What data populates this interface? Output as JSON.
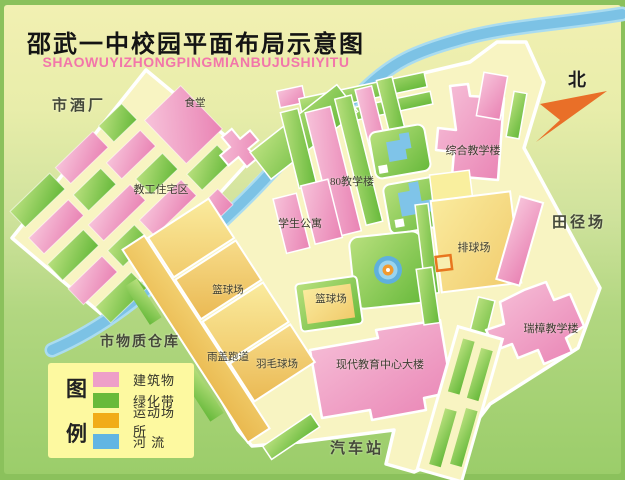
{
  "title": {
    "text": "邵武一中校园平面布局示意图",
    "pinyin": "SHAOWUYIZHONGPINGMIANBUJUSHIYITU"
  },
  "compass": {
    "north_label": "北"
  },
  "places": {
    "city_winery": "市酒厂",
    "canteen": "食堂",
    "staff_residential": "教工住宅区",
    "student_apartments": "学生公寓",
    "teaching_building_80": "80教学楼",
    "comprehensive_building": "综合教学楼",
    "track_field": "田径场",
    "volleyball_court": "排球场",
    "basketball_court_west": "篮球场",
    "basketball_court_center": "篮球场",
    "city_warehouse": "市物质仓库",
    "covered_track": "雨盖跑道",
    "badminton_court": "羽毛球场",
    "modern_education_center": "现代教育中心大楼",
    "ruizhang_building": "瑞樟教学楼",
    "bus_station": "汽车站"
  },
  "legend": {
    "title_char_top": "图",
    "title_char_bottom": "例",
    "items": [
      {
        "label": "建筑物",
        "color": "#ee9fc8"
      },
      {
        "label": "绿化带",
        "color": "#68ba3a"
      },
      {
        "label": "运动场所",
        "color": "#f1ac18"
      },
      {
        "label": "河 流",
        "color": "#62b5e3"
      }
    ]
  },
  "colors": {
    "building_pink": "#ee9fc8",
    "greenbelt": "#68ba3a",
    "sports": "#f1ac18",
    "river": "#62b5e3",
    "campus_ground": "#f8f4c2",
    "frame_green": "#8bc15c",
    "title_pinyin_pink": "#f276aa",
    "compass_arrow_orange": "#e96f28"
  }
}
